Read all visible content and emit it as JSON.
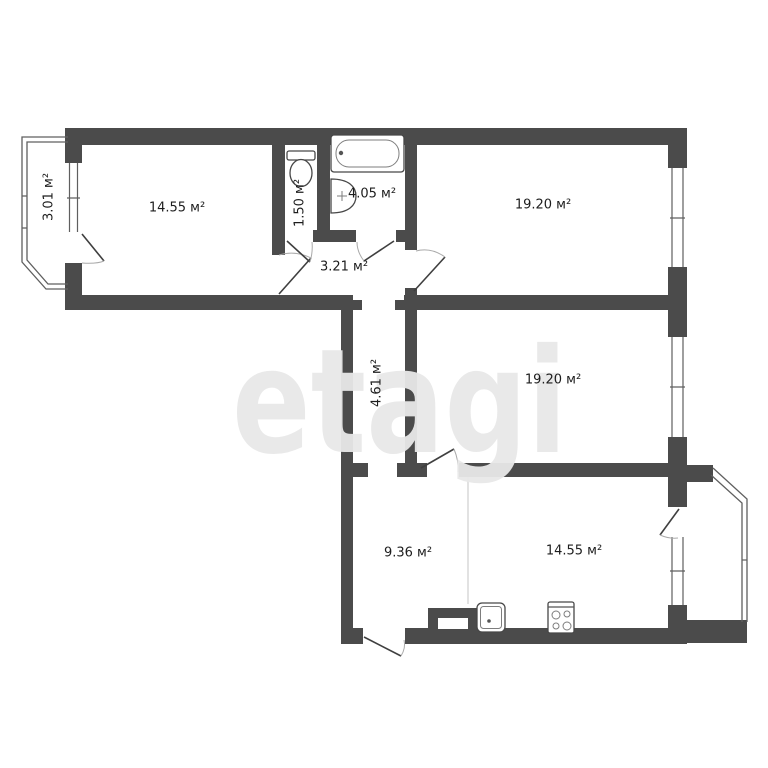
{
  "watermark": {
    "text": "etagi",
    "color": "#e8e8e8"
  },
  "colors": {
    "wall": "#4b4b4b",
    "line": "#5f5f5f",
    "label": "#1d1d1d",
    "arc": "#a9a9a9",
    "divider": "#d9d9d9"
  },
  "rooms": {
    "balcony_left": {
      "area_label": "3.01 м²"
    },
    "room_top_left": {
      "area_label": "14.55 м²"
    },
    "wc": {
      "area_label": "1.50 м²"
    },
    "bathroom": {
      "area_label": "4.05 м²"
    },
    "room_top_right": {
      "area_label": "19.20 м²"
    },
    "hallway": {
      "area_label": "3.21 м²"
    },
    "corridor": {
      "area_label": "4.61 м²"
    },
    "room_middle_right": {
      "area_label": "19.20 м²"
    },
    "entry_hall": {
      "area_label": "9.36 м²"
    },
    "kitchen": {
      "area_label": "14.55 м²"
    }
  },
  "fixture_icons": [
    "bathtub-icon",
    "wash-basin-icon",
    "toilet-icon",
    "kitchen-sink-icon",
    "stove-icon",
    "vent-shaft"
  ]
}
